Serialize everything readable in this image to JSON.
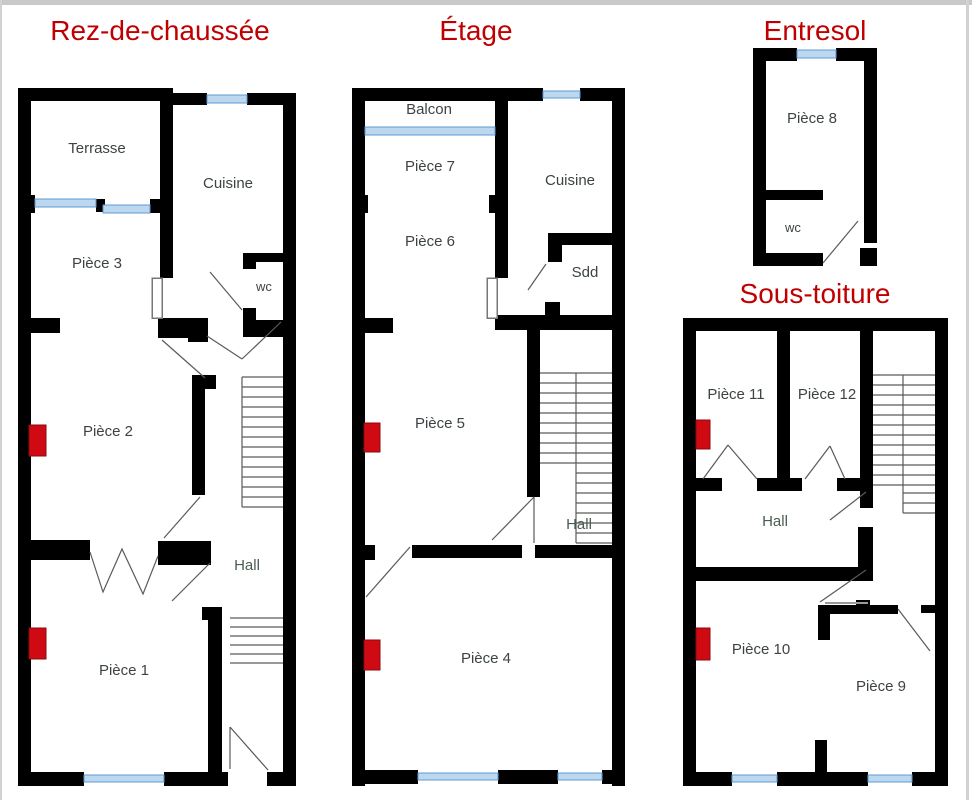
{
  "colors": {
    "wall": "#000000",
    "window_fill": "#bdd7ee",
    "window_stroke": "#5b9bd5",
    "red_box": "#cf0a12",
    "title": "#c00000",
    "label": "#3d4345",
    "hall_label": "#4a5d52",
    "line": "#5a5a5a",
    "leaf_stroke": "#777777",
    "top_border": "#c9c9c9",
    "edge": "#d2d2d2"
  },
  "plans": [
    {
      "title": "Rez-de-chaussée",
      "rooms": [
        "Terrasse",
        "Cuisine",
        "Pièce 3",
        "wc",
        "Pièce 2",
        "Hall",
        "Pièce 1"
      ]
    },
    {
      "title": "Étage",
      "rooms": [
        "Balcon",
        "Pièce 7",
        "Cuisine",
        "Pièce 6",
        "Sdd",
        "Pièce 5",
        "Hall",
        "Pièce 4"
      ]
    },
    {
      "title": "Entresol",
      "rooms": [
        "Pièce 8",
        "wc"
      ]
    },
    {
      "title": "Sous-toiture",
      "rooms": [
        "Pièce 11",
        "Pièce 12",
        "Hall",
        "Pièce 10",
        "Pièce 9"
      ]
    }
  ]
}
